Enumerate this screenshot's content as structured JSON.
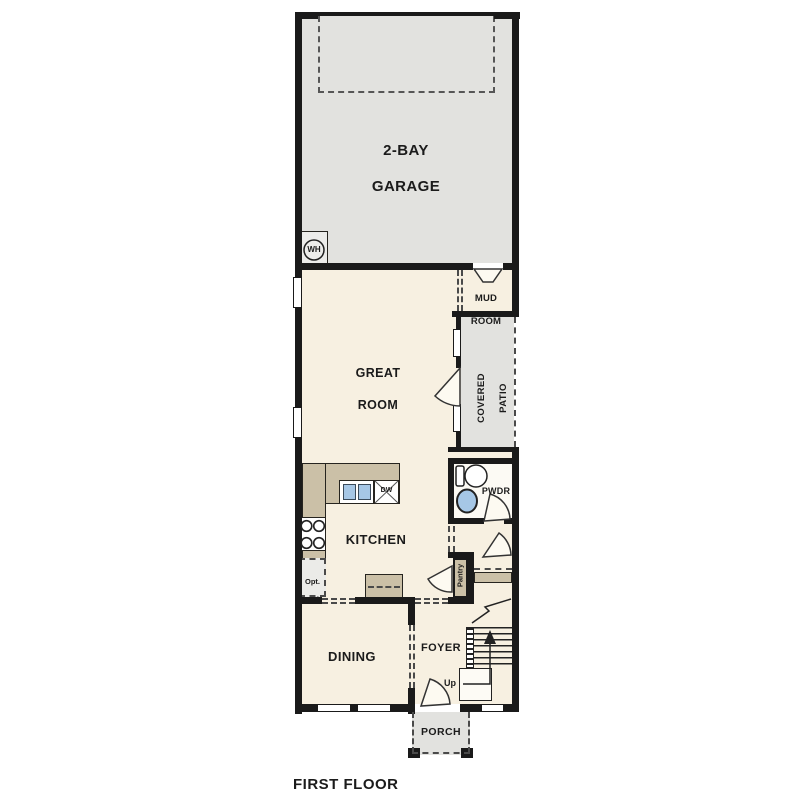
{
  "title": "FIRST FLOOR",
  "colors": {
    "wall": "#1a1a1a",
    "interior_cream": "#f7f0e1",
    "exterior_gray": "#e2e2df",
    "counter_tan": "#cbc0a7",
    "fixture_blue": "#a6c7e6",
    "powder_white": "#fcfaf4"
  },
  "rooms": {
    "garage": {
      "line1": "2-BAY",
      "line2": "GARAGE"
    },
    "mud": {
      "line1": "MUD",
      "line2": "ROOM"
    },
    "great": {
      "line1": "GREAT",
      "line2": "ROOM"
    },
    "patio": {
      "line1": "COVERED",
      "line2": "PATIO"
    },
    "powder": {
      "label": "PWDR"
    },
    "kitchen": {
      "label": "KITCHEN"
    },
    "pantry": {
      "label": "Pantry"
    },
    "dining": {
      "label": "DINING"
    },
    "foyer": {
      "label": "FOYER"
    },
    "porch": {
      "label": "PORCH"
    }
  },
  "fixtures": {
    "water_heater": "WH",
    "dishwasher": "DW",
    "opt_ref_line1": "Opt.",
    "opt_ref_line2": "Ref",
    "stairs_up": "Up"
  }
}
